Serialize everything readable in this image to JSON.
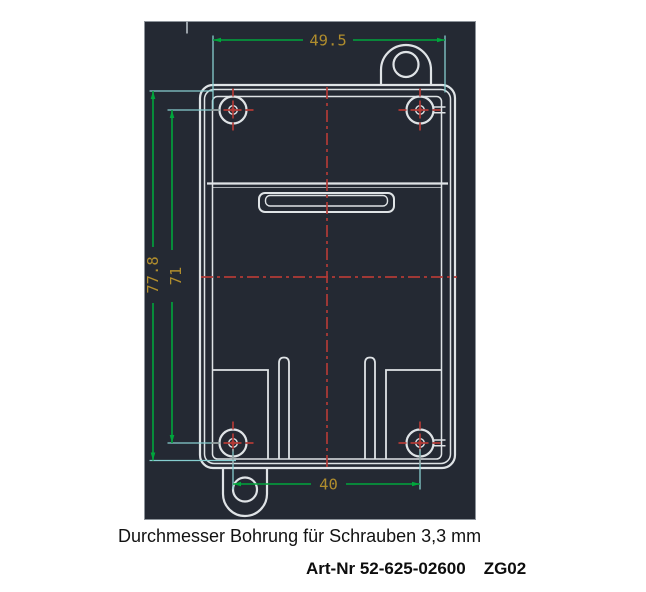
{
  "drawing": {
    "title_context": "enclosure-base-technical-drawing",
    "dimensions": {
      "inner_width_top": "49.5",
      "inner_height": "77.8",
      "hole_spacing_vertical": "71",
      "hole_spacing_horizontal": "40"
    },
    "features": {
      "screw_hole_count": 4,
      "mounting_tabs": [
        "top-right",
        "bottom-left"
      ]
    },
    "colors": {
      "viewport_background": "#242933",
      "outline": "#dfe3e6",
      "dimension_line": "#00a63c",
      "extension_line": "#86ced0",
      "centerline": "#b23a36",
      "dimension_text": "#b08d2d"
    }
  },
  "caption": "Durchmesser Bohrung für Schrauben 3,3 mm",
  "part_info": {
    "art_label": "Art-Nr 52-625-02600",
    "code": "ZG02"
  }
}
